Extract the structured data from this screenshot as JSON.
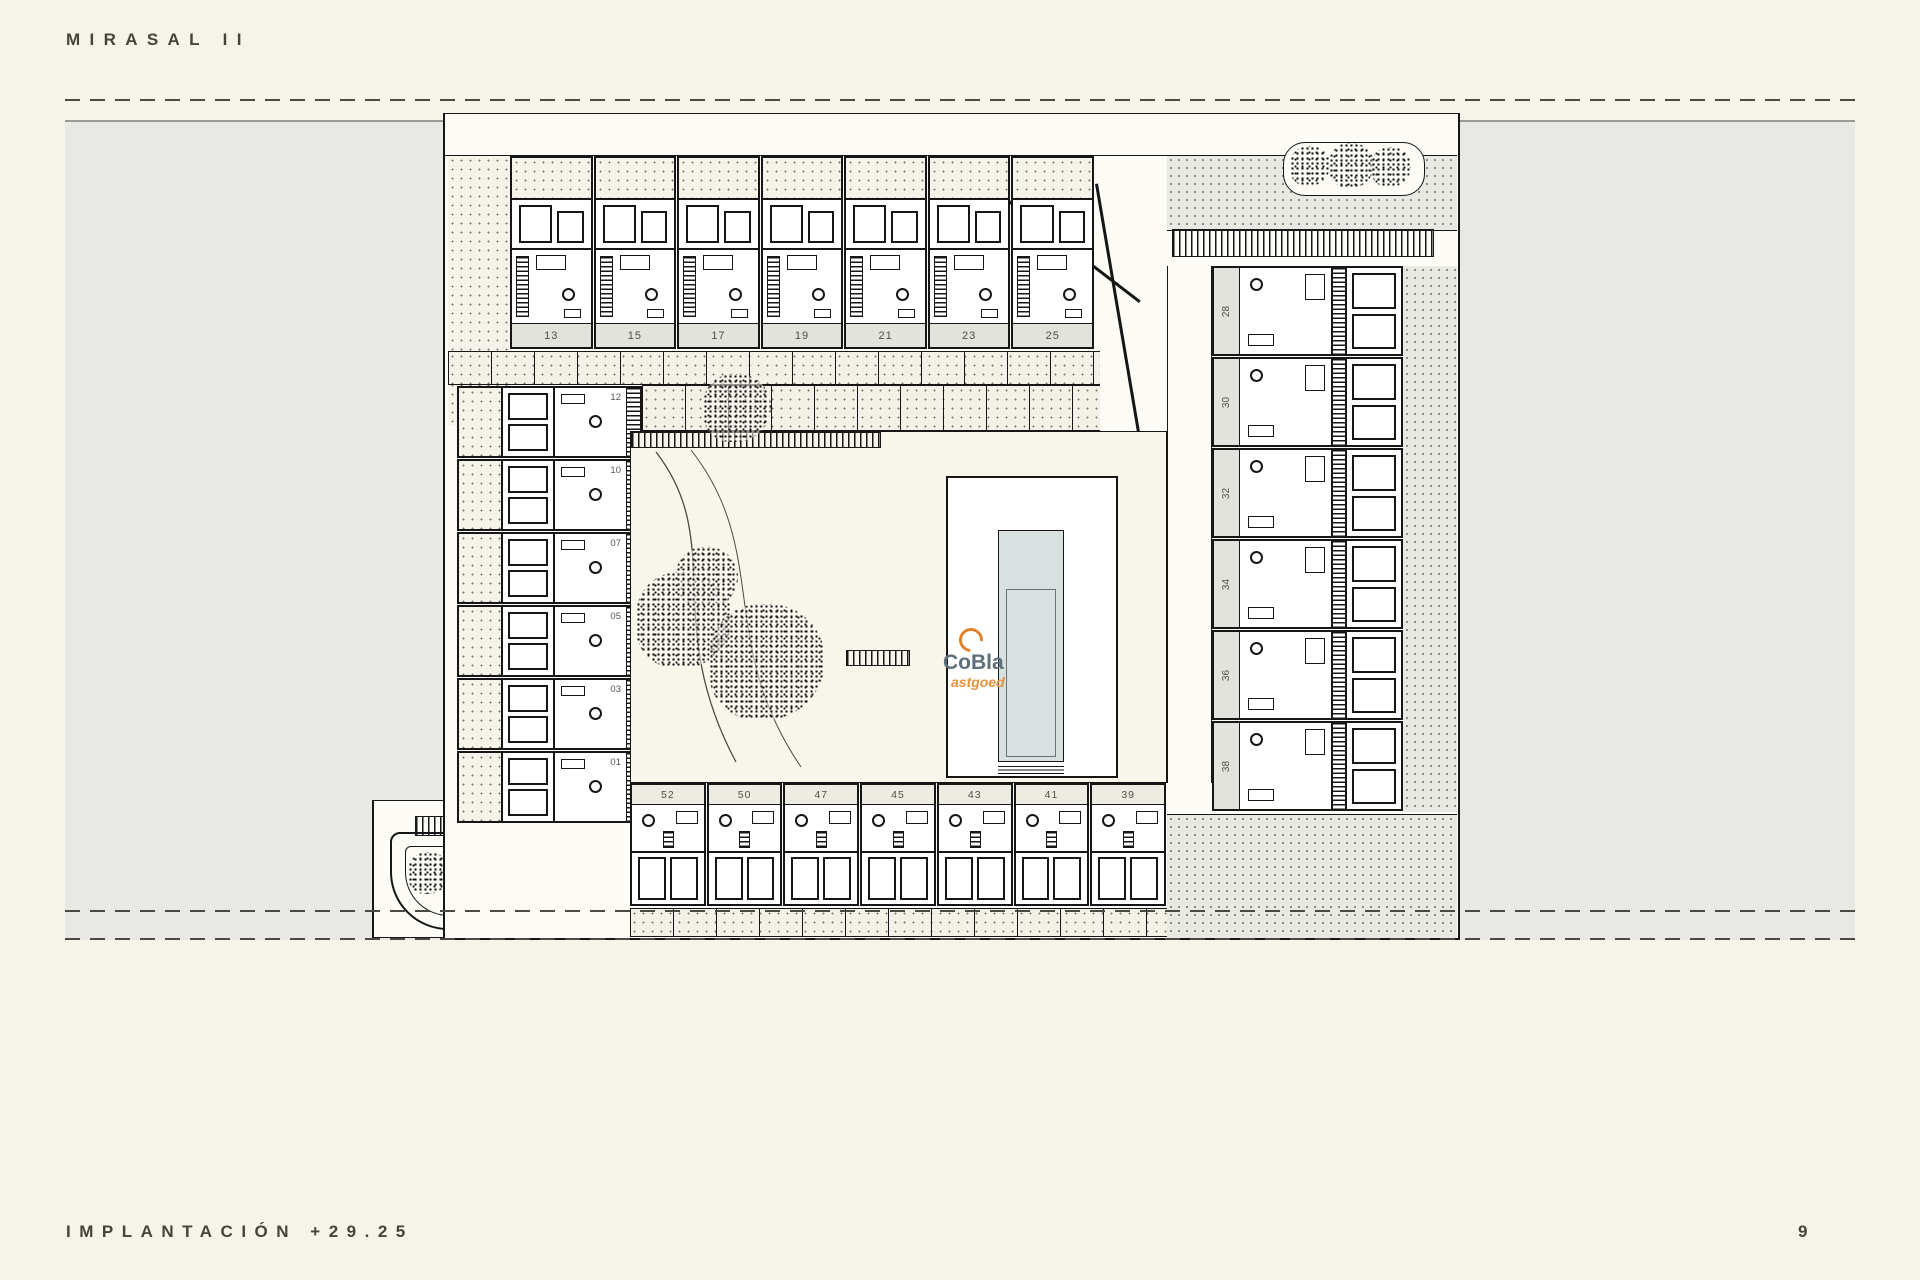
{
  "page": {
    "title": "MIRASAL II",
    "footer_label": "IMPLANTACIÓN +29.25",
    "page_number": "9"
  },
  "watermark": {
    "brand": "CoBla",
    "brand_sub": "astgoed"
  },
  "colors": {
    "paper": "#f6f3e9",
    "plan_paper": "#fcfbf6",
    "site_band_gray": "#e8e8e4",
    "line": "#161616",
    "pool_water": "#d8e1e0",
    "unit_label_band": "#e3e3dd",
    "watermark_orange": "#e0832f",
    "watermark_blue_gray": "#5d6e7b"
  },
  "plan": {
    "top_row_units": [
      "13",
      "15",
      "17",
      "19",
      "21",
      "23",
      "25"
    ],
    "left_column_units": [
      "12",
      "10",
      "07",
      "05",
      "03",
      "01"
    ],
    "right_column_units": [
      "28",
      "30",
      "32",
      "34",
      "36",
      "38"
    ],
    "bottom_row_units": [
      "52",
      "50",
      "47",
      "45",
      "43",
      "41",
      "39"
    ]
  }
}
